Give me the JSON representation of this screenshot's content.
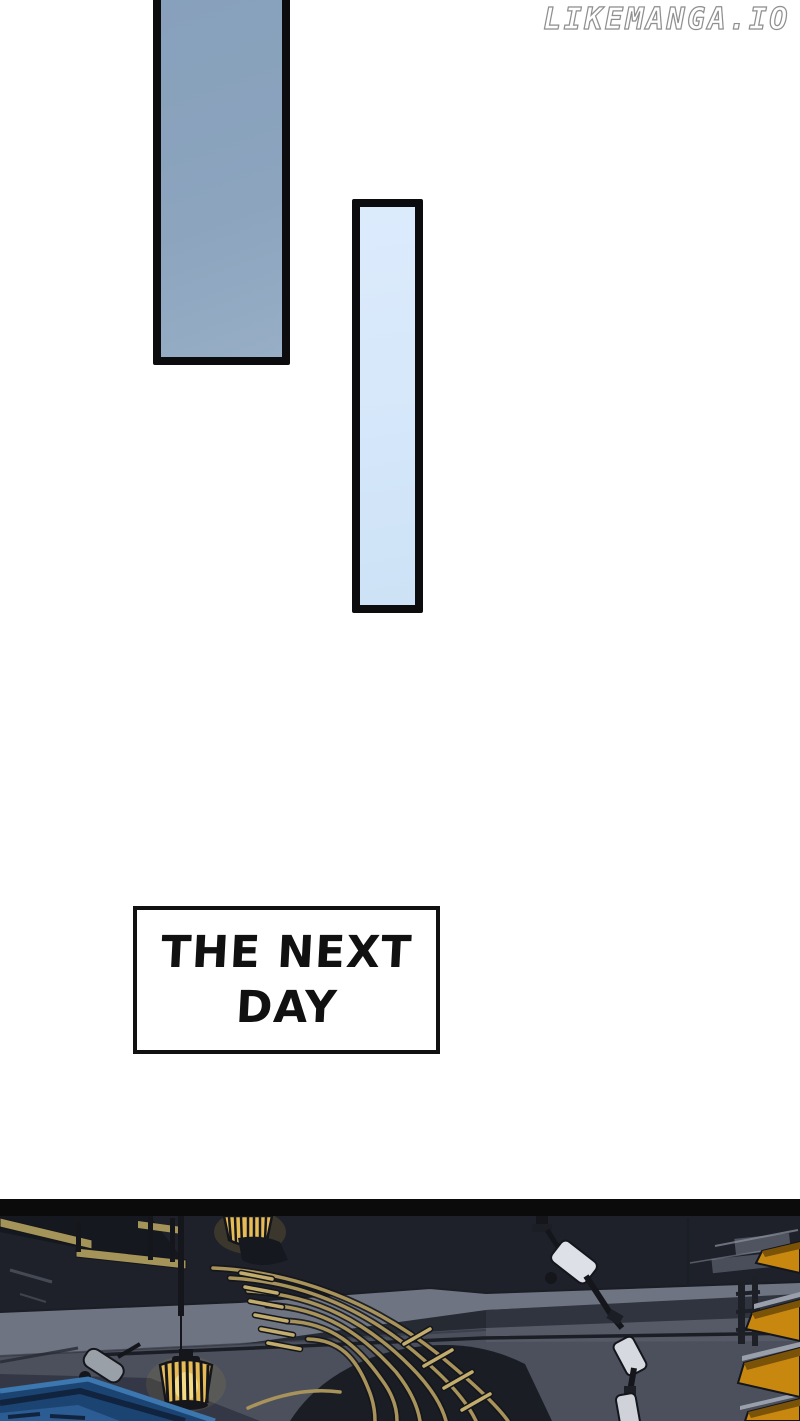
{
  "watermark": {
    "text": "LIKEMANGA.IO",
    "color": "#ffffff",
    "outline_color": "#8f8f8f"
  },
  "panels": {
    "tall": {
      "fill": "#8ca4be",
      "border_color": "#0c0c0e"
    },
    "narrow": {
      "fill": "#d8e9fb",
      "border_color": "#0c0c0e"
    }
  },
  "caption": {
    "text": "THE NEXT DAY",
    "line1": "THE NEXT",
    "line2": "DAY",
    "text_color": "#111111",
    "box_fill": "#ffffff",
    "border_color": "#111111"
  },
  "scene": {
    "divider_color": "#0b0b0c",
    "colors": {
      "ceiling": "#1e212a",
      "ceiling_mid": "#262a33",
      "sill_light": "#6f7482",
      "underband_dark": "#30343f",
      "wall": "#4b505c",
      "wall_light": "#555a66",
      "floor_dark": "#343846",
      "edge_line": "#1b1e25",
      "beam_tan": "#a59459",
      "deck_dark": "#15181e",
      "boat_gold": "#a8935a",
      "boat_gold_bright": "#c3ad6c",
      "hull_dark": "#171a21",
      "cage_glow": "#c79d3e",
      "cage_body": "#e7bc55",
      "cage_core": "#f6dd8a",
      "fixture_dark": "#14161c",
      "joint_gray": "#1b1e25",
      "spotlight_white": "#dde1e7",
      "spotlight_white2": "#d6dae0",
      "spotlight_white3": "#cfd3d9",
      "spotlight_gray": "#9aa0a8",
      "railing_blue": "#1c4472",
      "railing_blue_light": "#3d77b0",
      "railing_navy": "#10243f",
      "railing_blue_mid": "#2b5c93",
      "shelf_yellow": "#c8880f",
      "shelf_yellow_dark": "#7a5208",
      "slat_light": "#9aa0ab",
      "detail_light": "#8d93a0",
      "ladder_dark": "#1d2027"
    }
  }
}
